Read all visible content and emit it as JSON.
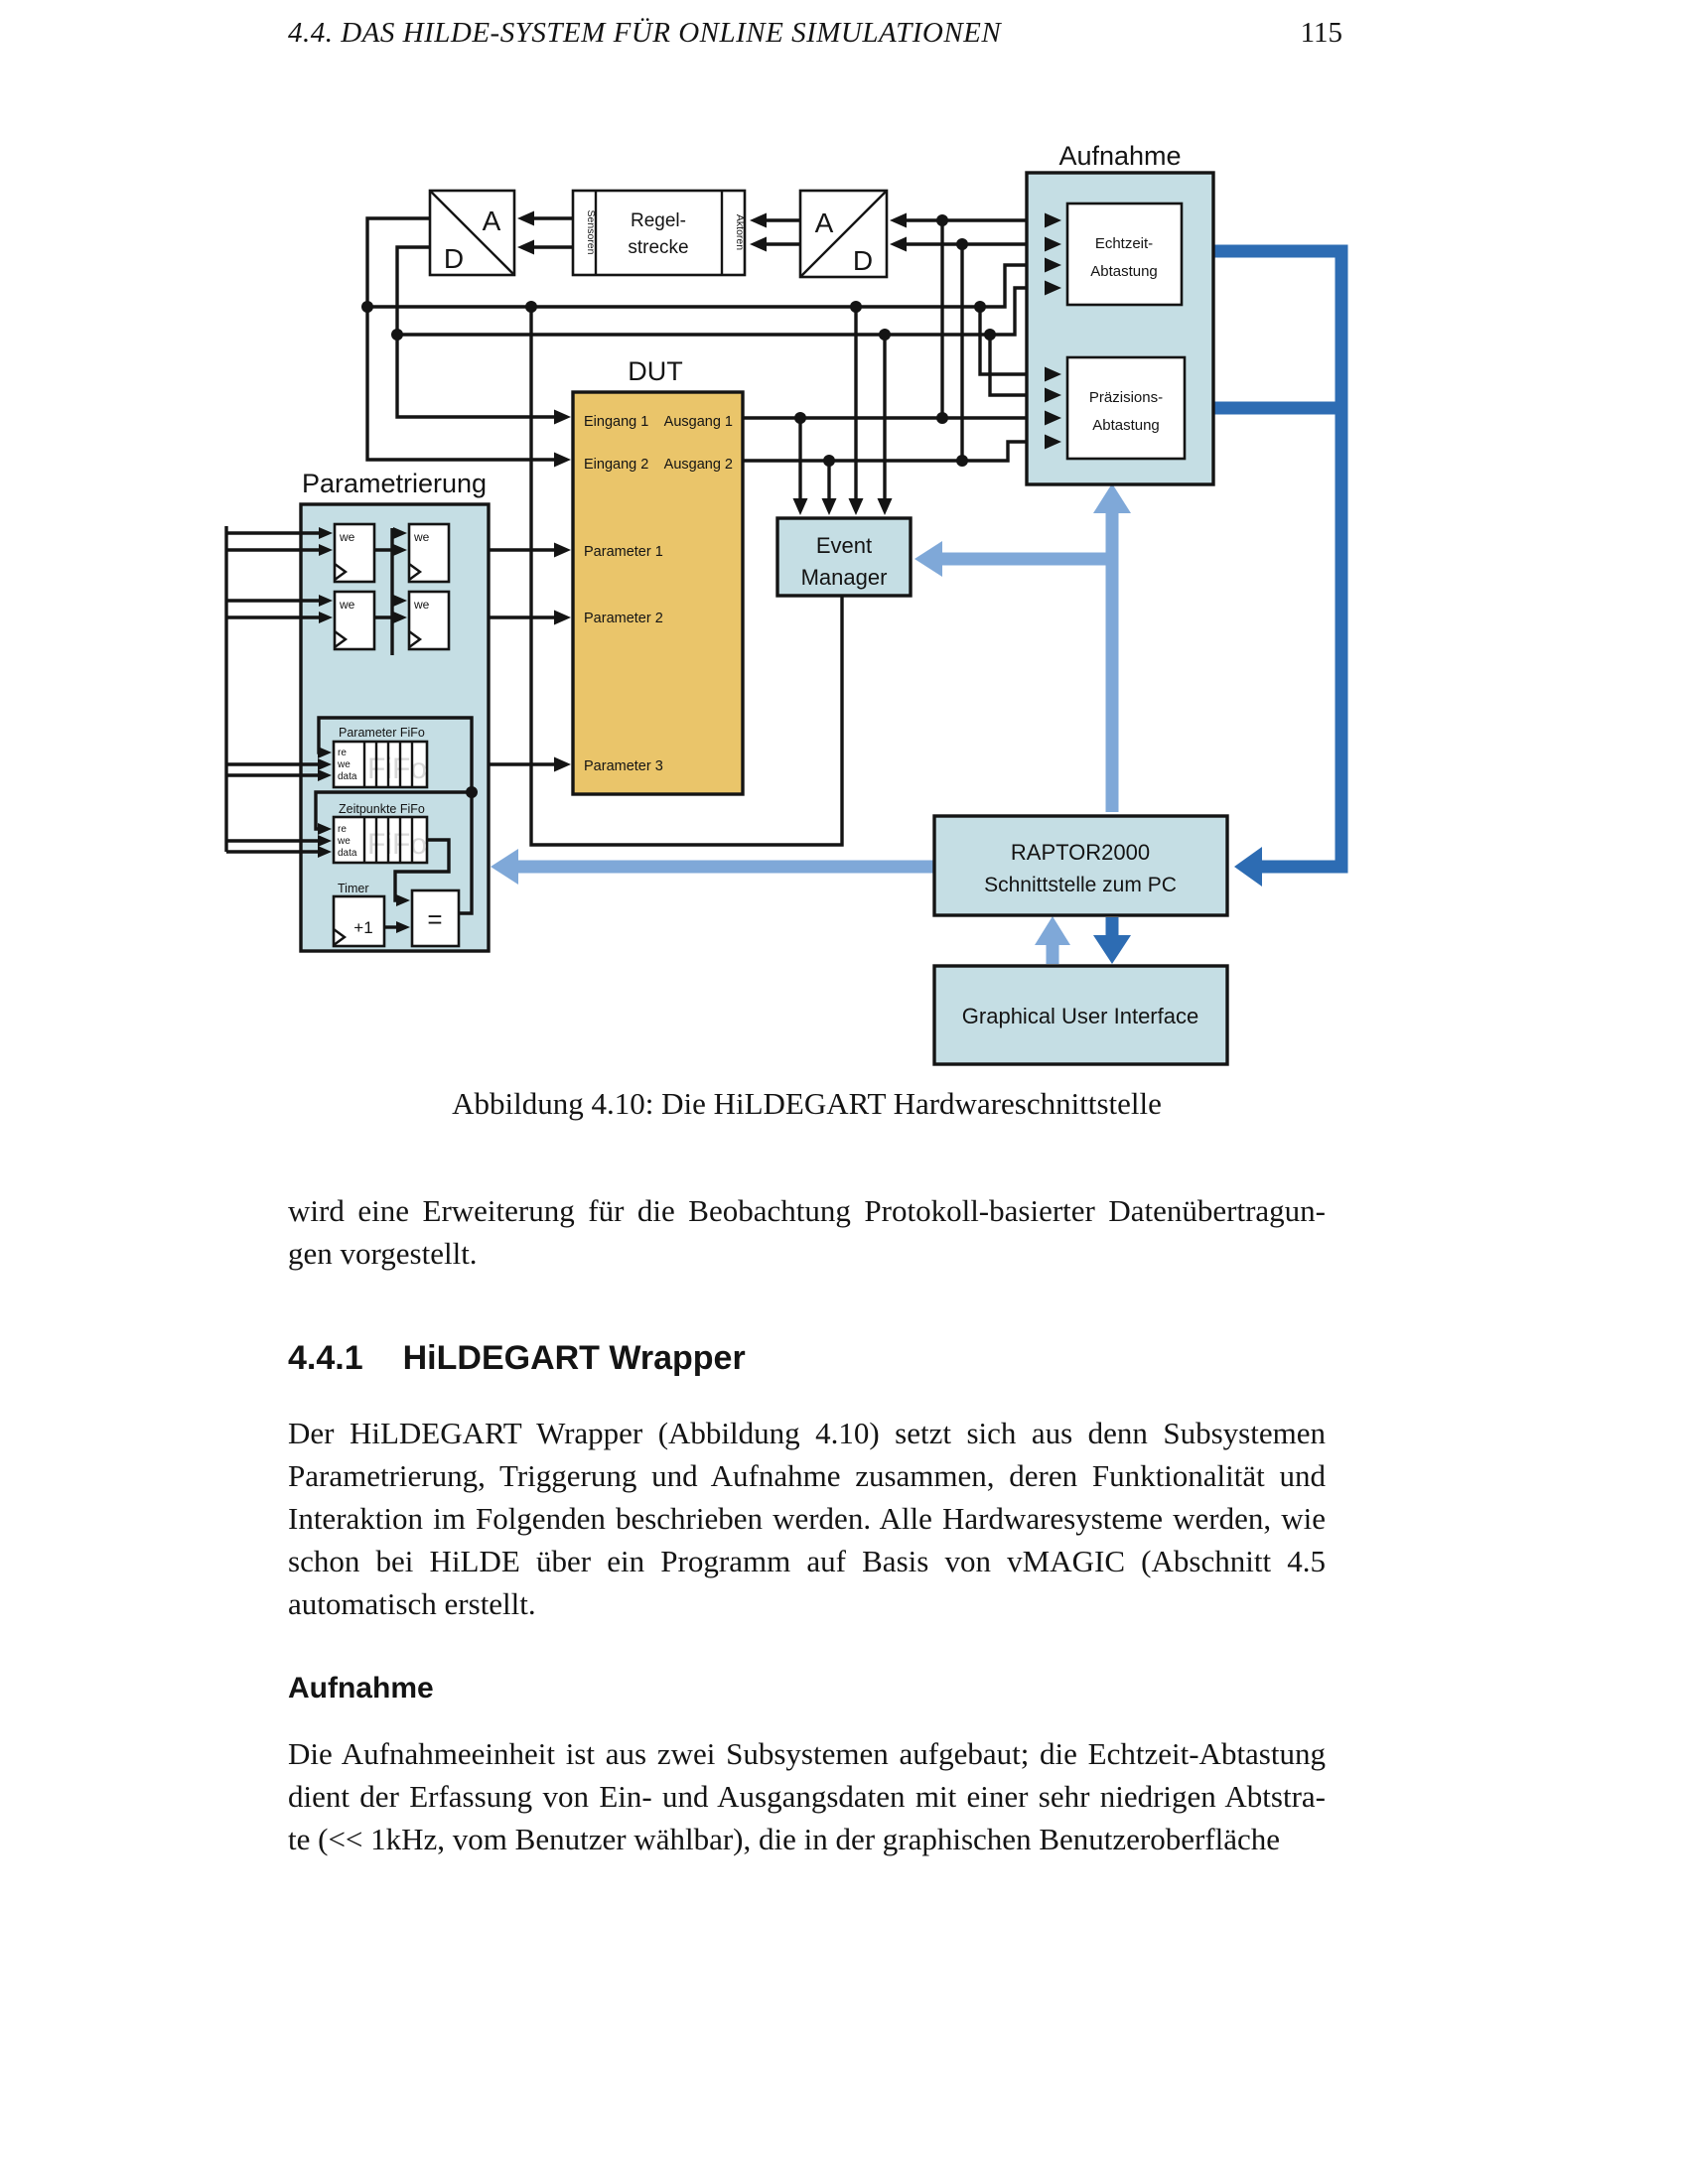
{
  "header": {
    "title": "4.4.  DAS HILDE-SYSTEM FÜR ONLINE SIMULATIONEN",
    "page_number": "115"
  },
  "figure": {
    "aufnahme_group": "Aufnahme",
    "echtzeit": [
      "Echtzeit-",
      "Abtastung"
    ],
    "praezisions": [
      "Präzisions-",
      "Abtastung"
    ],
    "ad_left": {
      "a": "A",
      "d": "D"
    },
    "ad_right": {
      "a": "A",
      "d": "D"
    },
    "regelstrecke": [
      "Regel-",
      "strecke"
    ],
    "sensoren": "Sensoren",
    "aktoren": "Aktoren",
    "dut": {
      "title": "DUT",
      "eingang1": "Eingang 1",
      "eingang2": "Eingang 2",
      "ausgang1": "Ausgang 1",
      "ausgang2": "Ausgang 2",
      "parameter1": "Parameter 1",
      "parameter2": "Parameter 2",
      "parameter3": "Parameter 3"
    },
    "parametrierung": {
      "title": "Parametrierung",
      "we": "we",
      "pfifo_title": "Parameter FiFo",
      "zfifo_title": "Zeitpunkte FiFo",
      "re": "re",
      "we_sig": "we",
      "data": "data",
      "fifo_watermark": "FiFo",
      "timer": "Timer",
      "plus1": "+1",
      "eq": "="
    },
    "event_manager": [
      "Event",
      "Manager"
    ],
    "raptor": [
      "RAPTOR2000",
      "Schnittstelle zum PC"
    ],
    "gui": "Graphical User Interface",
    "colors": {
      "box_fill": "#C5DEE4",
      "dut_fill": "#EAC56A",
      "light_blue": "#7FA8D8",
      "dark_blue": "#2D6CB3",
      "line_black": "#141414",
      "watermark_gray": "#D8D8D8"
    }
  },
  "caption": "Abbildung 4.10: Die HiLDEGART Hardwareschnittstelle",
  "paragraph_intro": {
    "lines": [
      "wird eine Erweiterung für die Beobachtung Protokoll-basierter Datenübertragun-",
      "gen vorgestellt."
    ]
  },
  "section": {
    "number": "4.4.1",
    "title": "HiLDEGART Wrapper"
  },
  "paragraph_wrapper": {
    "lines": [
      "Der HiLDEGART Wrapper (Abbildung 4.10) setzt sich aus denn Subsystemen",
      "Parametrierung, Triggerung und Aufnahme zusammen, deren Funktionalität und",
      "Interaktion im Folgenden beschrieben werden. Alle Hardwaresysteme werden, wie",
      "schon bei HiLDE über ein Programm auf Basis von vMAGIC (Abschnitt 4.5",
      "automatisch erstellt."
    ]
  },
  "subsection": {
    "title": "Aufnahme"
  },
  "paragraph_aufnahme": {
    "lines": [
      "Die Aufnahmeeinheit ist aus zwei Subsystemen aufgebaut; die Echtzeit-Abtastung",
      "dient der Erfassung von Ein- und Ausgangsdaten mit einer sehr niedrigen Abtstra-",
      "te (<< 1kHz, vom Benutzer wählbar), die in der graphischen Benutzeroberfläche"
    ]
  }
}
